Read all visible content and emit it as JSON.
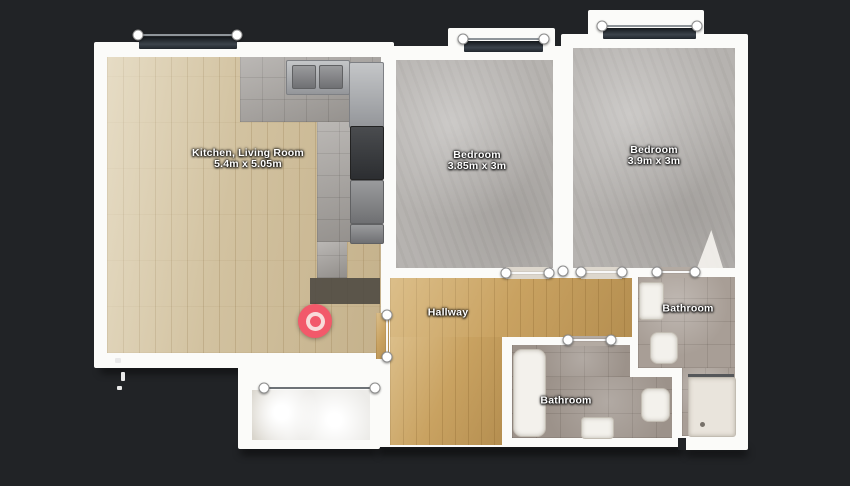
{
  "floorplan": {
    "rooms": [
      {
        "name": "Kitchen, Living Room",
        "dimensions": "5.4m x 5.05m"
      },
      {
        "name": "Bedroom",
        "dimensions": "3.85m x 3m"
      },
      {
        "name": "Bedroom",
        "dimensions": "3.9m x 3m"
      },
      {
        "name": "Hallway",
        "dimensions": ""
      },
      {
        "name": "Bathroom",
        "dimensions": ""
      },
      {
        "name": "Bathroom",
        "dimensions": ""
      }
    ],
    "marker": {
      "type": "capture-point",
      "color": "#f2596a"
    },
    "colors": {
      "background": "#212326",
      "walls": "#fbfbf9",
      "wood_living": "#d2c2a0",
      "wood_hallway": "#c9a261",
      "carpet": "#b6b3b0",
      "bathroom_tile": "#9c928a",
      "kitchen_tile": "#a4a09c",
      "window": "#2b323a"
    }
  }
}
